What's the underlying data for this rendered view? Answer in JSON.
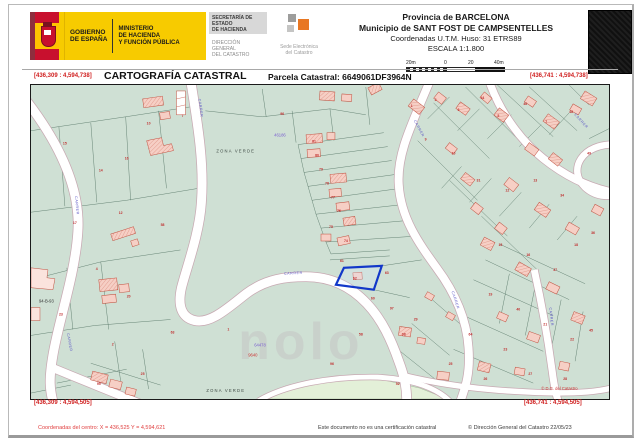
{
  "header": {
    "gobierno": [
      "GOBIERNO",
      "DE ESPAÑA"
    ],
    "ministerio": [
      "MINISTERIO",
      "DE HACIENDA",
      "Y FUNCIÓN PÚBLICA"
    ],
    "secretaria": [
      "SECRETARÍA DE ESTADO",
      "DE HACIENDA"
    ],
    "direccion": [
      "DIRECCIÓN GENERAL",
      "DEL CATASTRO"
    ],
    "sede": [
      "Sede Electrónica",
      "del Catastro"
    ],
    "provincia": "Provincia de BARCELONA",
    "municipio": "Municipio de SANT FOST DE CAMPSENTELLES",
    "coordenadas": "Coordenadas U.T.M. Huso: 31 ETRS89",
    "escala": "ESCALA 1:1.800",
    "scale_ticks": [
      "20m",
      "0",
      "20",
      "40m"
    ]
  },
  "titlebar": {
    "title": "CARTOGRAFÍA CATASTRAL",
    "parcela": "Parcela Catastral: 6649061DF3964N",
    "coord_tl": "[436,309 : 4,594,738]",
    "coord_tr": "[436,741 : 4,594,738]",
    "coord_bl": "[436,309 : 4,594,505]",
    "coord_br": "[436,741 : 4,594,505]"
  },
  "map": {
    "watermark": "nolo",
    "highlight_label": "62",
    "street_labels": [
      {
        "t": "CARRER",
        "x": 254,
        "y": 191,
        "r": -3,
        "s": 4.2
      },
      {
        "t": "CARRER",
        "x": 168,
        "y": 14,
        "r": 83,
        "s": 3.4
      },
      {
        "t": "CARRER",
        "x": 44,
        "y": 112,
        "r": 84,
        "s": 3.4
      },
      {
        "t": "CARRER",
        "x": 36,
        "y": 250,
        "r": 80,
        "s": 3.4
      },
      {
        "t": "CARRER",
        "x": 384,
        "y": 36,
        "r": 62,
        "s": 3.4
      },
      {
        "t": "CARRER",
        "x": 422,
        "y": 208,
        "r": 72,
        "s": 3.4
      },
      {
        "t": "CARRER",
        "x": 520,
        "y": 224,
        "r": 84,
        "s": 3.4
      },
      {
        "t": "CARRER",
        "x": 545,
        "y": 30,
        "r": 48,
        "s": 3.4
      }
    ],
    "area_labels": [
      {
        "t": "ZONA VERDE",
        "x": 186,
        "y": 68,
        "c": "#3f4a44",
        "s": 5.4,
        "ls": 1.2
      },
      {
        "t": "ZONA VERDE",
        "x": 176,
        "y": 309,
        "c": "#3f4a44",
        "s": 5.4,
        "ls": 1.2
      },
      {
        "t": "46186",
        "x": 244,
        "y": 52,
        "c": "#7a5fd0",
        "s": 4.2
      },
      {
        "t": "64478",
        "x": 224,
        "y": 263,
        "c": "#7a5fd0",
        "s": 4.2
      },
      {
        "t": "9640",
        "x": 218,
        "y": 273,
        "c": "#cc3333",
        "s": 3.8
      },
      {
        "t": "94-B-93",
        "x": 8,
        "y": 219,
        "c": "#333333",
        "s": 3.6
      },
      {
        "t": "© D.G. del Catastro",
        "x": 512,
        "y": 307,
        "c": "#cc3333",
        "s": 3.6
      }
    ],
    "parcel_numbers": [
      {
        "x": 70,
        "y": 87,
        "t": "14"
      },
      {
        "x": 34,
        "y": 60,
        "t": "15"
      },
      {
        "x": 118,
        "y": 40,
        "t": "10"
      },
      {
        "x": 152,
        "y": 32,
        "t": "7"
      },
      {
        "x": 96,
        "y": 75,
        "t": "16"
      },
      {
        "x": 44,
        "y": 140,
        "t": "17"
      },
      {
        "x": 90,
        "y": 130,
        "t": "12"
      },
      {
        "x": 132,
        "y": 142,
        "t": "58"
      },
      {
        "x": 66,
        "y": 186,
        "t": "4"
      },
      {
        "x": 98,
        "y": 214,
        "t": "20"
      },
      {
        "x": 30,
        "y": 232,
        "t": "23"
      },
      {
        "x": 82,
        "y": 262,
        "t": "2"
      },
      {
        "x": 112,
        "y": 292,
        "t": "25"
      },
      {
        "x": 68,
        "y": 302,
        "t": "95"
      },
      {
        "x": 142,
        "y": 250,
        "t": "63"
      },
      {
        "x": 198,
        "y": 247,
        "t": "1"
      },
      {
        "x": 252,
        "y": 30,
        "t": "96"
      },
      {
        "x": 284,
        "y": 58,
        "t": "81"
      },
      {
        "x": 287,
        "y": 72,
        "t": "80"
      },
      {
        "x": 291,
        "y": 86,
        "t": "79"
      },
      {
        "x": 297,
        "y": 100,
        "t": "78"
      },
      {
        "x": 303,
        "y": 114,
        "t": "77"
      },
      {
        "x": 309,
        "y": 128,
        "t": "76"
      },
      {
        "x": 301,
        "y": 144,
        "t": "75"
      },
      {
        "x": 316,
        "y": 158,
        "t": "74"
      },
      {
        "x": 312,
        "y": 178,
        "t": "61"
      },
      {
        "x": 325,
        "y": 196,
        "t": "62"
      },
      {
        "x": 357,
        "y": 190,
        "t": "63"
      },
      {
        "x": 343,
        "y": 216,
        "t": "60"
      },
      {
        "x": 362,
        "y": 226,
        "t": "97"
      },
      {
        "x": 382,
        "y": 22,
        "t": "1"
      },
      {
        "x": 406,
        "y": 16,
        "t": "2"
      },
      {
        "x": 429,
        "y": 26,
        "t": "3"
      },
      {
        "x": 453,
        "y": 14,
        "t": "44"
      },
      {
        "x": 469,
        "y": 32,
        "t": "5"
      },
      {
        "x": 496,
        "y": 20,
        "t": "46"
      },
      {
        "x": 517,
        "y": 38,
        "t": "7"
      },
      {
        "x": 542,
        "y": 28,
        "t": "48"
      },
      {
        "x": 396,
        "y": 56,
        "t": "9"
      },
      {
        "x": 424,
        "y": 70,
        "t": "10"
      },
      {
        "x": 449,
        "y": 97,
        "t": "31"
      },
      {
        "x": 478,
        "y": 107,
        "t": "12"
      },
      {
        "x": 506,
        "y": 97,
        "t": "13"
      },
      {
        "x": 533,
        "y": 112,
        "t": "34"
      },
      {
        "x": 471,
        "y": 162,
        "t": "15"
      },
      {
        "x": 499,
        "y": 172,
        "t": "16"
      },
      {
        "x": 526,
        "y": 187,
        "t": "37"
      },
      {
        "x": 547,
        "y": 162,
        "t": "18"
      },
      {
        "x": 461,
        "y": 212,
        "t": "19"
      },
      {
        "x": 489,
        "y": 227,
        "t": "40"
      },
      {
        "x": 516,
        "y": 242,
        "t": "21"
      },
      {
        "x": 543,
        "y": 257,
        "t": "22"
      },
      {
        "x": 476,
        "y": 267,
        "t": "23"
      },
      {
        "x": 441,
        "y": 252,
        "t": "64"
      },
      {
        "x": 421,
        "y": 282,
        "t": "25"
      },
      {
        "x": 456,
        "y": 297,
        "t": "26"
      },
      {
        "x": 501,
        "y": 292,
        "t": "27"
      },
      {
        "x": 536,
        "y": 297,
        "t": "28"
      },
      {
        "x": 386,
        "y": 237,
        "t": "29"
      },
      {
        "x": 374,
        "y": 252,
        "t": "98"
      },
      {
        "x": 331,
        "y": 252,
        "t": "58"
      },
      {
        "x": 302,
        "y": 282,
        "t": "96"
      },
      {
        "x": 368,
        "y": 302,
        "t": "52"
      },
      {
        "x": 560,
        "y": 70,
        "t": "49"
      },
      {
        "x": 564,
        "y": 150,
        "t": "36"
      },
      {
        "x": 562,
        "y": 248,
        "t": "45"
      }
    ]
  },
  "footer": {
    "centro": "Coordenadas del centro: X = 436,525 Y = 4,594,621",
    "aviso": "Este documento no es una certificación catastral",
    "copyright": "© Dirección General del Catastro 22/05/23"
  },
  "colors": {
    "header_yellow": "#f7cb00",
    "map_green": "#cfe0d4",
    "map_light_green": "#e3f0d8",
    "building_fill": "#f6cfc5",
    "building_stroke": "#c0503f",
    "parcel_number_red": "#c03030",
    "street_blue": "#5a55c5",
    "highlight_blue": "#1237c9",
    "coord_red": "#d02020"
  }
}
